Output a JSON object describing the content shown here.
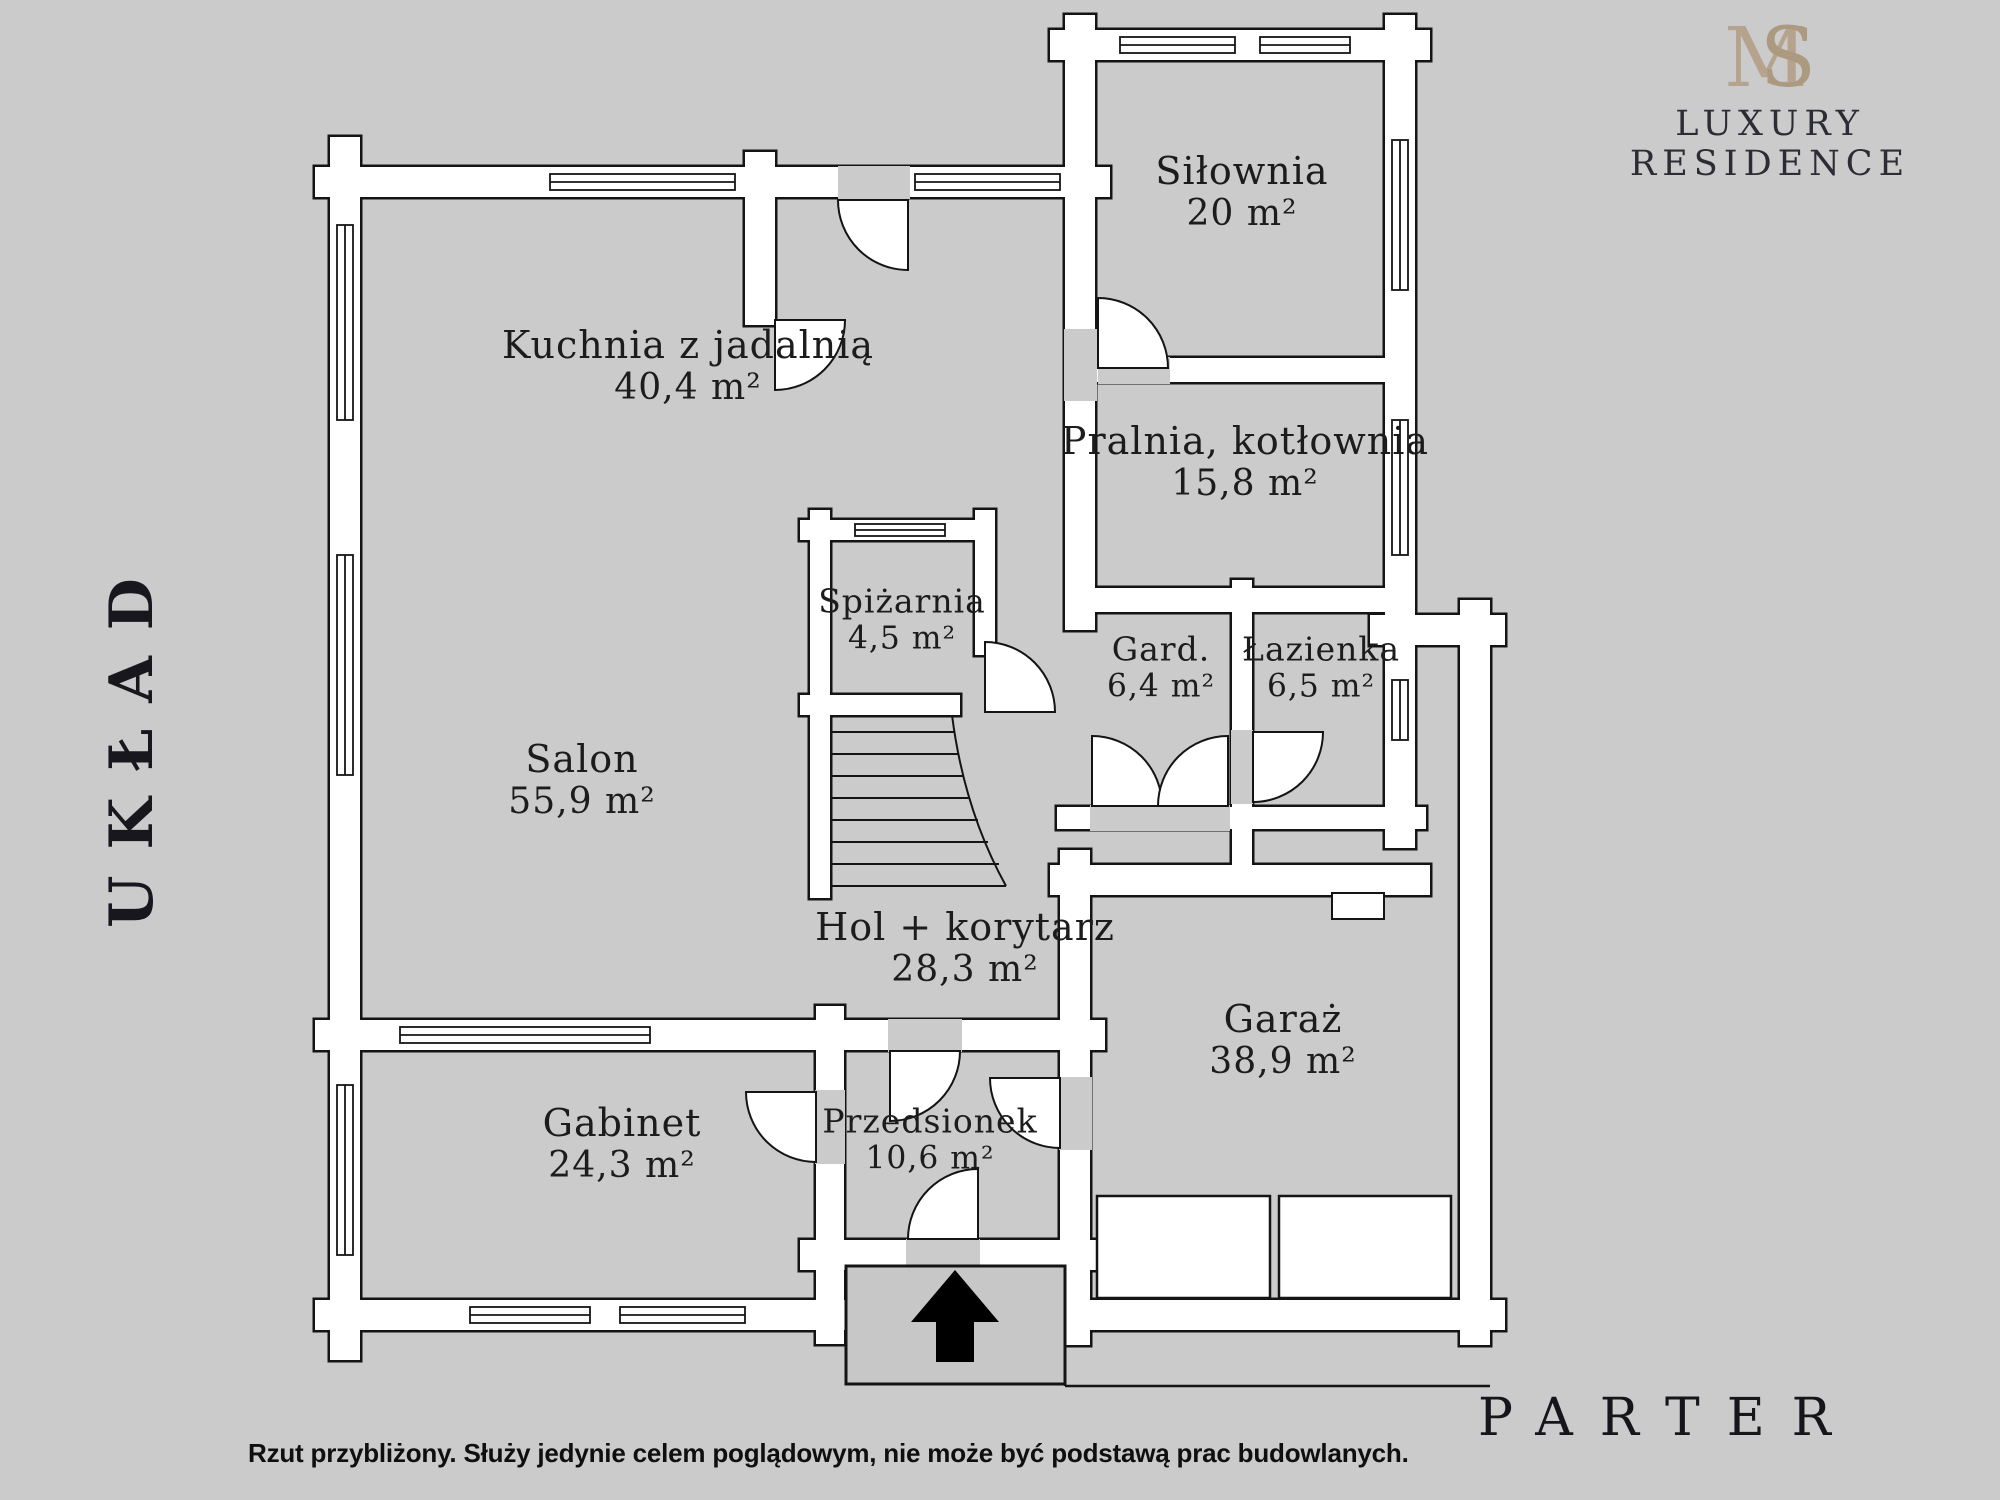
{
  "brand": {
    "monogram_m": "M",
    "monogram_s": "S",
    "name": "LUXURY RESIDENCE"
  },
  "side_label": "UKŁAD",
  "floor_label": "PARTER",
  "disclaimer": "Rzut przybliżony. Służy jedynie celem poglądowym, nie może być podstawą prac budowlanych.",
  "rooms": [
    {
      "id": "silownia",
      "name": "Siłownia",
      "area": "20 m²"
    },
    {
      "id": "pralnia",
      "name": "Pralnia, kotłownia",
      "area": "15,8 m²"
    },
    {
      "id": "kuchnia",
      "name": "Kuchnia z jadalnią",
      "area": "40,4 m²"
    },
    {
      "id": "spizarnia",
      "name": "Spiżarnia",
      "area": "4,5 m²"
    },
    {
      "id": "salon",
      "name": "Salon",
      "area": "55,9 m²"
    },
    {
      "id": "garderoba",
      "name": "Gard.",
      "area": "6,4 m²"
    },
    {
      "id": "lazienka",
      "name": "Łazienka",
      "area": "6,5 m²"
    },
    {
      "id": "hol",
      "name": "Hol + korytarz",
      "area": "28,3 m²"
    },
    {
      "id": "garaz",
      "name": "Garaż",
      "area": "38,9 m²"
    },
    {
      "id": "gabinet",
      "name": "Gabinet",
      "area": "24,3 m²"
    },
    {
      "id": "przedsionek",
      "name": "Przedsionek",
      "area": "10,6 m²"
    }
  ]
}
